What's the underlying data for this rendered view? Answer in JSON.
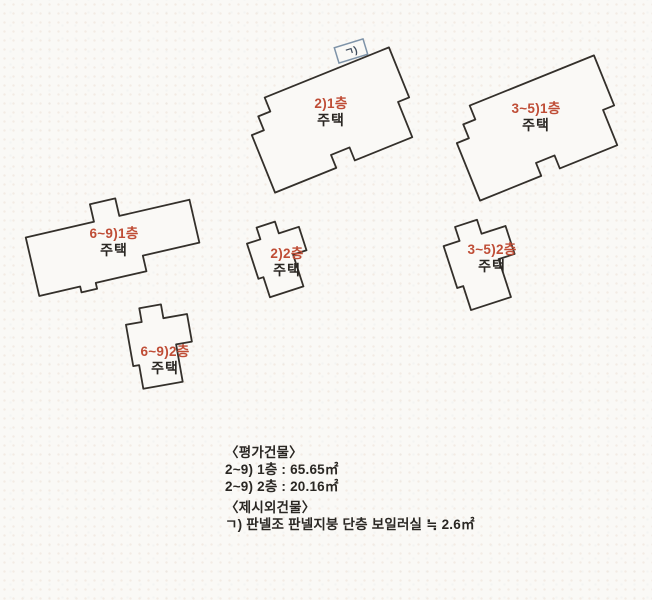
{
  "scene": {
    "width": 652,
    "height": 600,
    "background_color": "#faf9f6",
    "outline_color": "#34302b",
    "accent_color": "#bf4d36",
    "text_color": "#2a2723",
    "annex_border_color": "#7e93a8",
    "annex_text_color": "#3f4c5c"
  },
  "shapes": {
    "plan_1f": [
      [
        26,
        0
      ],
      [
        160,
        0
      ],
      [
        160,
        54
      ],
      [
        148,
        54
      ],
      [
        148,
        92
      ],
      [
        86,
        92
      ],
      [
        86,
        78
      ],
      [
        66,
        78
      ],
      [
        66,
        92
      ],
      [
        0,
        92
      ],
      [
        0,
        30
      ],
      [
        13,
        30
      ],
      [
        13,
        15
      ],
      [
        26,
        15
      ]
    ],
    "plan_1f_c": [
      [
        0,
        18
      ],
      [
        70,
        18
      ],
      [
        70,
        0
      ],
      [
        96,
        0
      ],
      [
        96,
        18
      ],
      [
        168,
        18
      ],
      [
        168,
        62
      ],
      [
        110,
        62
      ],
      [
        110,
        78
      ],
      [
        58,
        78
      ],
      [
        58,
        84
      ],
      [
        42,
        84
      ],
      [
        42,
        78
      ],
      [
        0,
        78
      ]
    ],
    "plan_2f": [
      [
        16,
        0
      ],
      [
        38,
        0
      ],
      [
        38,
        14
      ],
      [
        62,
        14
      ],
      [
        62,
        42
      ],
      [
        46,
        42
      ],
      [
        46,
        80
      ],
      [
        6,
        80
      ],
      [
        6,
        56
      ],
      [
        0,
        56
      ],
      [
        0,
        14
      ],
      [
        16,
        14
      ]
    ]
  },
  "buildings": [
    {
      "id": "unit-2-1f",
      "shape": "plan_1f",
      "cx": 332,
      "cy": 120,
      "rotation": -22,
      "scale": 1.0,
      "floor_label": "2)1층",
      "type_label": "주택",
      "label_cx": 331,
      "label_cy": 113
    },
    {
      "id": "unit-3-5-1f",
      "shape": "plan_1f",
      "cx": 537,
      "cy": 128,
      "rotation": -22,
      "scale": 1.0,
      "floor_label": "3~5)1층",
      "type_label": "주택",
      "label_cx": 536,
      "label_cy": 118
    },
    {
      "id": "unit-6-9-1f",
      "shape": "plan_1f_c",
      "cx": 113,
      "cy": 242,
      "rotation": -13,
      "scale": 1.0,
      "floor_label": "6~9)1층",
      "type_label": "주택",
      "label_cx": 114,
      "label_cy": 243
    },
    {
      "id": "unit-2-2f",
      "shape": "plan_2f",
      "cx": 280,
      "cy": 257,
      "rotation": -18,
      "scale": 0.88,
      "floor_label": "2)2층",
      "type_label": "주택",
      "label_cx": 287,
      "label_cy": 263
    },
    {
      "id": "unit-3-5-2f",
      "shape": "plan_2f",
      "cx": 483,
      "cy": 262,
      "rotation": -18,
      "scale": 1.05,
      "floor_label": "3~5)2층",
      "type_label": "주택",
      "label_cx": 492,
      "label_cy": 259
    },
    {
      "id": "unit-6-9-2f",
      "shape": "plan_2f",
      "cx": 161,
      "cy": 345,
      "rotation": -10,
      "scale": 1.0,
      "floor_label": "6~9)2층",
      "type_label": "주택",
      "label_cx": 165,
      "label_cy": 361
    }
  ],
  "annex": {
    "label": "ㄱ)",
    "cx": 351,
    "cy": 51,
    "width": 30,
    "height": 16,
    "rotation": -17
  },
  "notes": {
    "appraised_heading": "〈평가건물〉",
    "appraised_items": [
      "2~9) 1층 : 65.65㎡",
      "2~9) 2층 : 20.16㎡"
    ],
    "extra_heading": "〈제시외건물〉",
    "extra_items": [
      "ㄱ) 판넬조 판넬지붕 단층 보일러실 ≒ 2.6㎡"
    ]
  }
}
